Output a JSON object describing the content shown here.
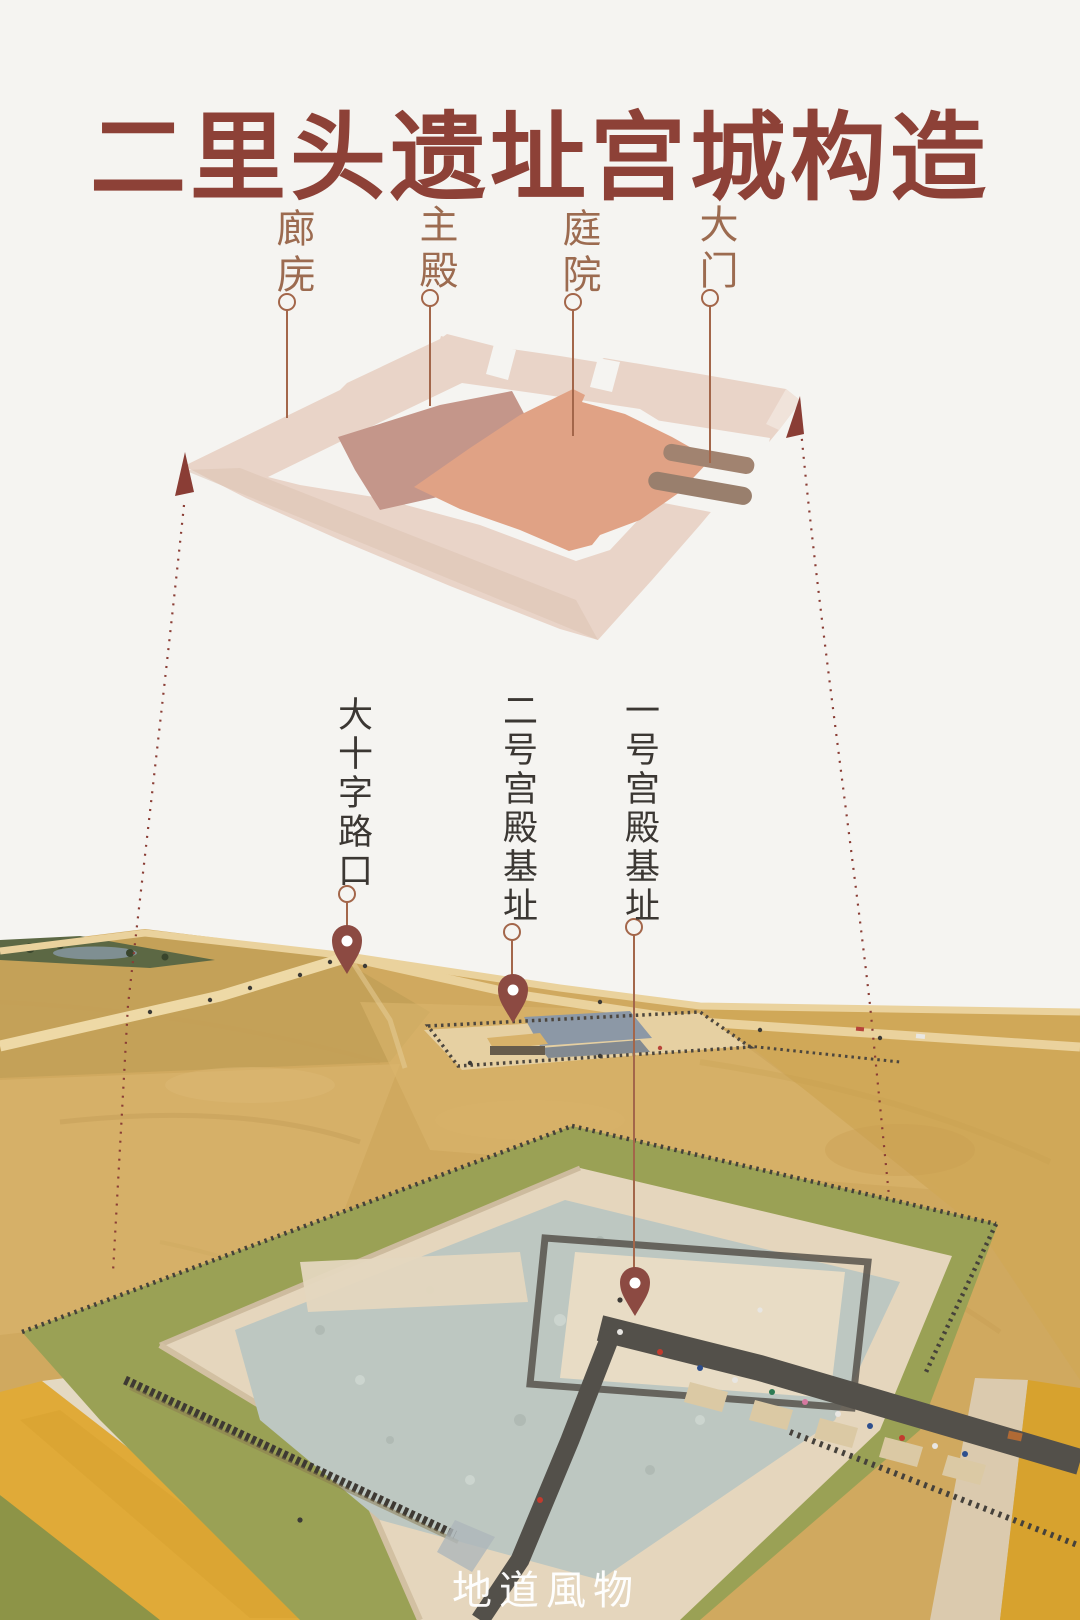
{
  "title": {
    "text": "二里头遗址宫城构造"
  },
  "diagram": {
    "description": "isometric-palace-plan",
    "labels": [
      {
        "id": "corridor",
        "text": "廊庑"
      },
      {
        "id": "main-hall",
        "text": "主殿"
      },
      {
        "id": "courtyard",
        "text": "庭院"
      },
      {
        "id": "gate",
        "text": "大门"
      }
    ],
    "colors": {
      "corridor_ring": "#e9d4c8",
      "main_hall": "#c4968a",
      "courtyard": "#e0a285",
      "gate_strips": "#a18370"
    }
  },
  "photo": {
    "description": "aerial-view-of-erlitou-site",
    "labels": [
      {
        "id": "crossroads",
        "text": "大十字路口"
      },
      {
        "id": "palace2",
        "text": "二号宫殿基址"
      },
      {
        "id": "palace1",
        "text": "一号宫殿基址"
      }
    ],
    "colors": {
      "field": "#d0a95f",
      "platform": "#e5d6bd",
      "gravel_court": "#bdc7c1",
      "canal": "#e0aa38",
      "pin": "#8c4a42"
    }
  },
  "watermark": {
    "text": "地道風物"
  },
  "accent_colors": {
    "title": "#8d4137",
    "label_brown": "#9c6b50",
    "label_dark": "#3b3733",
    "callout_line": "#a3664a",
    "arrow_dash": "#8a3d35"
  }
}
